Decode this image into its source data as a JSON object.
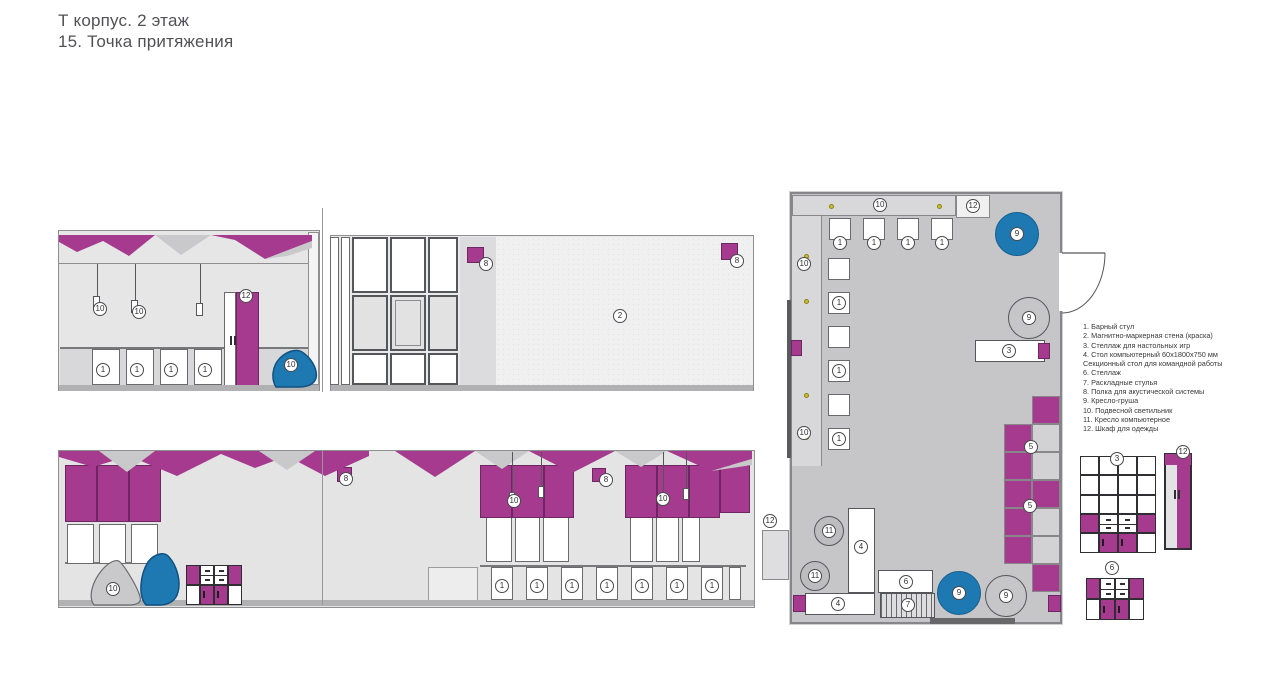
{
  "title": {
    "line1": "Т корпус. 2 этаж",
    "line2": "15. Точка притяжения"
  },
  "legend": [
    "1. Барный стул",
    "2. Магнитно-маркерная стена (краска)",
    "3. Стеллаж для настольных игр",
    "4. Стол компьютерный 60х1800х750 мм",
    "Секционный стол для командной работы",
    "6. Стеллаж",
    "7. Раскладные стулья",
    "8. Полка для акустической системы",
    "9. Кресло-груша",
    "10. Подвесной светильник",
    "11. Кресло компьютерное",
    "12. Шкаф для одежды"
  ],
  "colors": {
    "purple": "#a63a8f",
    "blue": "#1e78b2",
    "yellow": "#cdbf2a",
    "planbg": "#c6c6c8",
    "strip": "#d8d8da"
  },
  "markers": [
    {
      "n": "10",
      "x": 100,
      "y": 309
    },
    {
      "n": "10",
      "x": 139,
      "y": 312
    },
    {
      "n": "12",
      "x": 246,
      "y": 296
    },
    {
      "n": "1",
      "x": 103,
      "y": 370
    },
    {
      "n": "1",
      "x": 137,
      "y": 370
    },
    {
      "n": "1",
      "x": 171,
      "y": 370
    },
    {
      "n": "1",
      "x": 205,
      "y": 370
    },
    {
      "n": "10",
      "x": 291,
      "y": 365
    },
    {
      "n": "8",
      "x": 486,
      "y": 264
    },
    {
      "n": "2",
      "x": 620,
      "y": 316
    },
    {
      "n": "8",
      "x": 737,
      "y": 261
    },
    {
      "n": "8",
      "x": 346,
      "y": 479
    },
    {
      "n": "10",
      "x": 113,
      "y": 589
    },
    {
      "n": "10",
      "x": 514,
      "y": 501
    },
    {
      "n": "8",
      "x": 606,
      "y": 480
    },
    {
      "n": "10",
      "x": 663,
      "y": 499
    },
    {
      "n": "1",
      "x": 502,
      "y": 586
    },
    {
      "n": "1",
      "x": 537,
      "y": 586
    },
    {
      "n": "1",
      "x": 572,
      "y": 586
    },
    {
      "n": "1",
      "x": 607,
      "y": 586
    },
    {
      "n": "1",
      "x": 642,
      "y": 586
    },
    {
      "n": "1",
      "x": 677,
      "y": 586
    },
    {
      "n": "1",
      "x": 712,
      "y": 586
    },
    {
      "n": "10",
      "x": 880,
      "y": 205
    },
    {
      "n": "12",
      "x": 973,
      "y": 206
    },
    {
      "n": "1",
      "x": 840,
      "y": 243
    },
    {
      "n": "1",
      "x": 874,
      "y": 243
    },
    {
      "n": "1",
      "x": 908,
      "y": 243
    },
    {
      "n": "1",
      "x": 942,
      "y": 243
    },
    {
      "n": "9",
      "x": 1017,
      "y": 234
    },
    {
      "n": "10",
      "x": 804,
      "y": 264
    },
    {
      "n": "9",
      "x": 1029,
      "y": 318
    },
    {
      "n": "1",
      "x": 839,
      "y": 303
    },
    {
      "n": "1",
      "x": 839,
      "y": 371
    },
    {
      "n": "10",
      "x": 804,
      "y": 433
    },
    {
      "n": "1",
      "x": 839,
      "y": 439
    },
    {
      "n": "3",
      "x": 1009,
      "y": 351
    },
    {
      "n": "5",
      "x": 1031,
      "y": 447
    },
    {
      "n": "5",
      "x": 1030,
      "y": 506
    },
    {
      "n": "11",
      "x": 829,
      "y": 531
    },
    {
      "n": "11",
      "x": 815,
      "y": 576
    },
    {
      "n": "4",
      "x": 861,
      "y": 547
    },
    {
      "n": "4",
      "x": 838,
      "y": 604
    },
    {
      "n": "6",
      "x": 906,
      "y": 582
    },
    {
      "n": "7",
      "x": 908,
      "y": 605
    },
    {
      "n": "9",
      "x": 959,
      "y": 593
    },
    {
      "n": "9",
      "x": 1006,
      "y": 596
    },
    {
      "n": "12",
      "x": 770,
      "y": 521
    },
    {
      "n": "3",
      "x": 1117,
      "y": 459
    },
    {
      "n": "12",
      "x": 1183,
      "y": 452
    },
    {
      "n": "6",
      "x": 1112,
      "y": 568
    }
  ],
  "plan": {
    "lights": [
      [
        831,
        206
      ],
      [
        939,
        206
      ],
      [
        806,
        256
      ],
      [
        806,
        301
      ],
      [
        806,
        395
      ],
      [
        806,
        437
      ]
    ]
  }
}
